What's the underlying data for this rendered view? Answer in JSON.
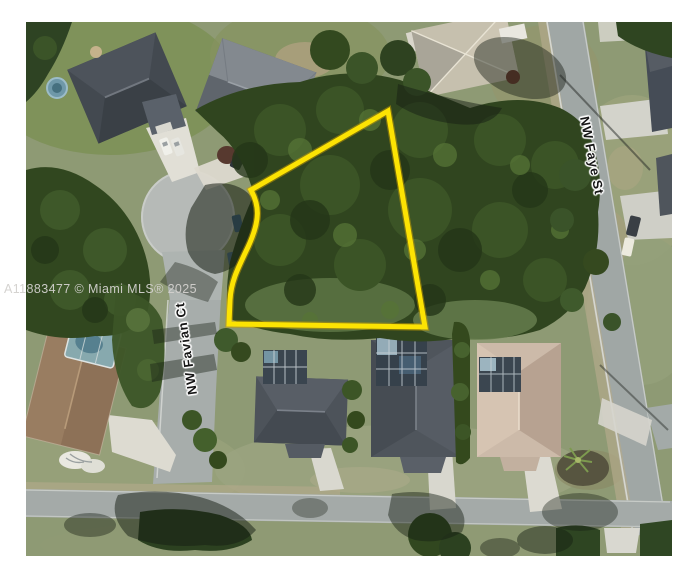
{
  "watermark": {
    "text": "A11883477 © Miami MLS® 2025"
  },
  "map": {
    "street_labels": [
      {
        "id": "favian",
        "name": "NW Favian Ct"
      },
      {
        "id": "faye",
        "name": "NW Faye St"
      }
    ],
    "overlay": {
      "parcel_outline_color": "#fce303"
    }
  }
}
